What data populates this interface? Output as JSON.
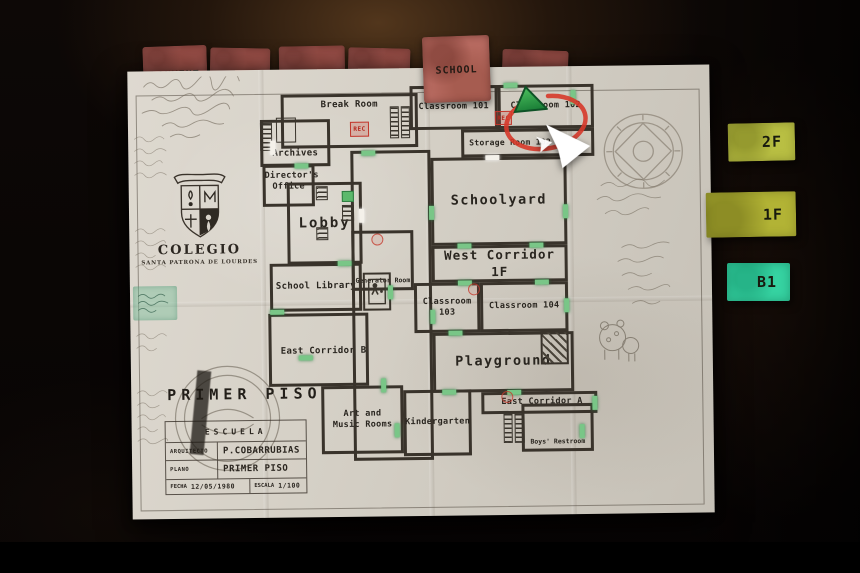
{
  "hud": {
    "location_tabs": [
      {
        "label": "CONVENT",
        "active": false
      },
      {
        "label": "TOWN",
        "active": false
      },
      {
        "label": "PROCESSING",
        "active": false
      },
      {
        "label": "MALL",
        "active": false
      },
      {
        "label": "SCHOOL",
        "active": true
      },
      {
        "label": "CEMETERY",
        "active": false
      }
    ],
    "floor_tabs": [
      {
        "label": "2F",
        "color": "#b9bf43",
        "active": false
      },
      {
        "label": "1F",
        "color": "#b2b335",
        "active": true
      },
      {
        "label": "B1",
        "color": "#36d3a2",
        "active": false
      }
    ]
  },
  "map": {
    "emblem": {
      "title": "COLEGIO",
      "subtitle": "SANTA PATRONA DE LOURDES"
    },
    "plan": {
      "heading": "PRIMER PISO",
      "school_row": "ESCUELA",
      "architect_label": "ARQUITECTO",
      "architect_value": "P.COBARRUBIAS",
      "plan_label": "PLANO",
      "plan_value": "PRIMER PISO",
      "date_label": "FECHA",
      "date_value": "12/05/1980",
      "scale_label": "ESCALA",
      "scale_value": "1/100"
    },
    "rooms": {
      "break_room": "Break Room",
      "archives": "Archives",
      "directors_office": "Director's Office",
      "lobby": "Lobby",
      "generator_room": "Generator Room",
      "school_library": "School Library",
      "east_corridor_b": "East Corridor B",
      "art_and_music_rooms": "Art and Music Rooms",
      "kindergarten": "Kindergarten",
      "schoolyard": "Schoolyard",
      "west_corridor_1f": "West Corridor 1F",
      "classroom_101": "Classroom 101",
      "classroom_102": "Classroom 102",
      "storage_room": "Storage Room 102",
      "classroom_103": "Classroom 103",
      "classroom_104": "Classroom 104",
      "playground": "Playground",
      "east_corridor_a": "East Corridor A",
      "boys_restroom": "Boys' Restroom"
    },
    "markers": {
      "save_label": "REC"
    },
    "colors": {
      "paper": "#d6d1c7",
      "wall": "#39332b",
      "door_green": "#79c687",
      "location_tab": "#b0655f",
      "floor_yellow": "#b9bf43",
      "floor_teal": "#36d3a2",
      "player_marker": "#2fa04a",
      "highlight_circle": "#d63a2a",
      "save_red": "#c2372c"
    }
  }
}
